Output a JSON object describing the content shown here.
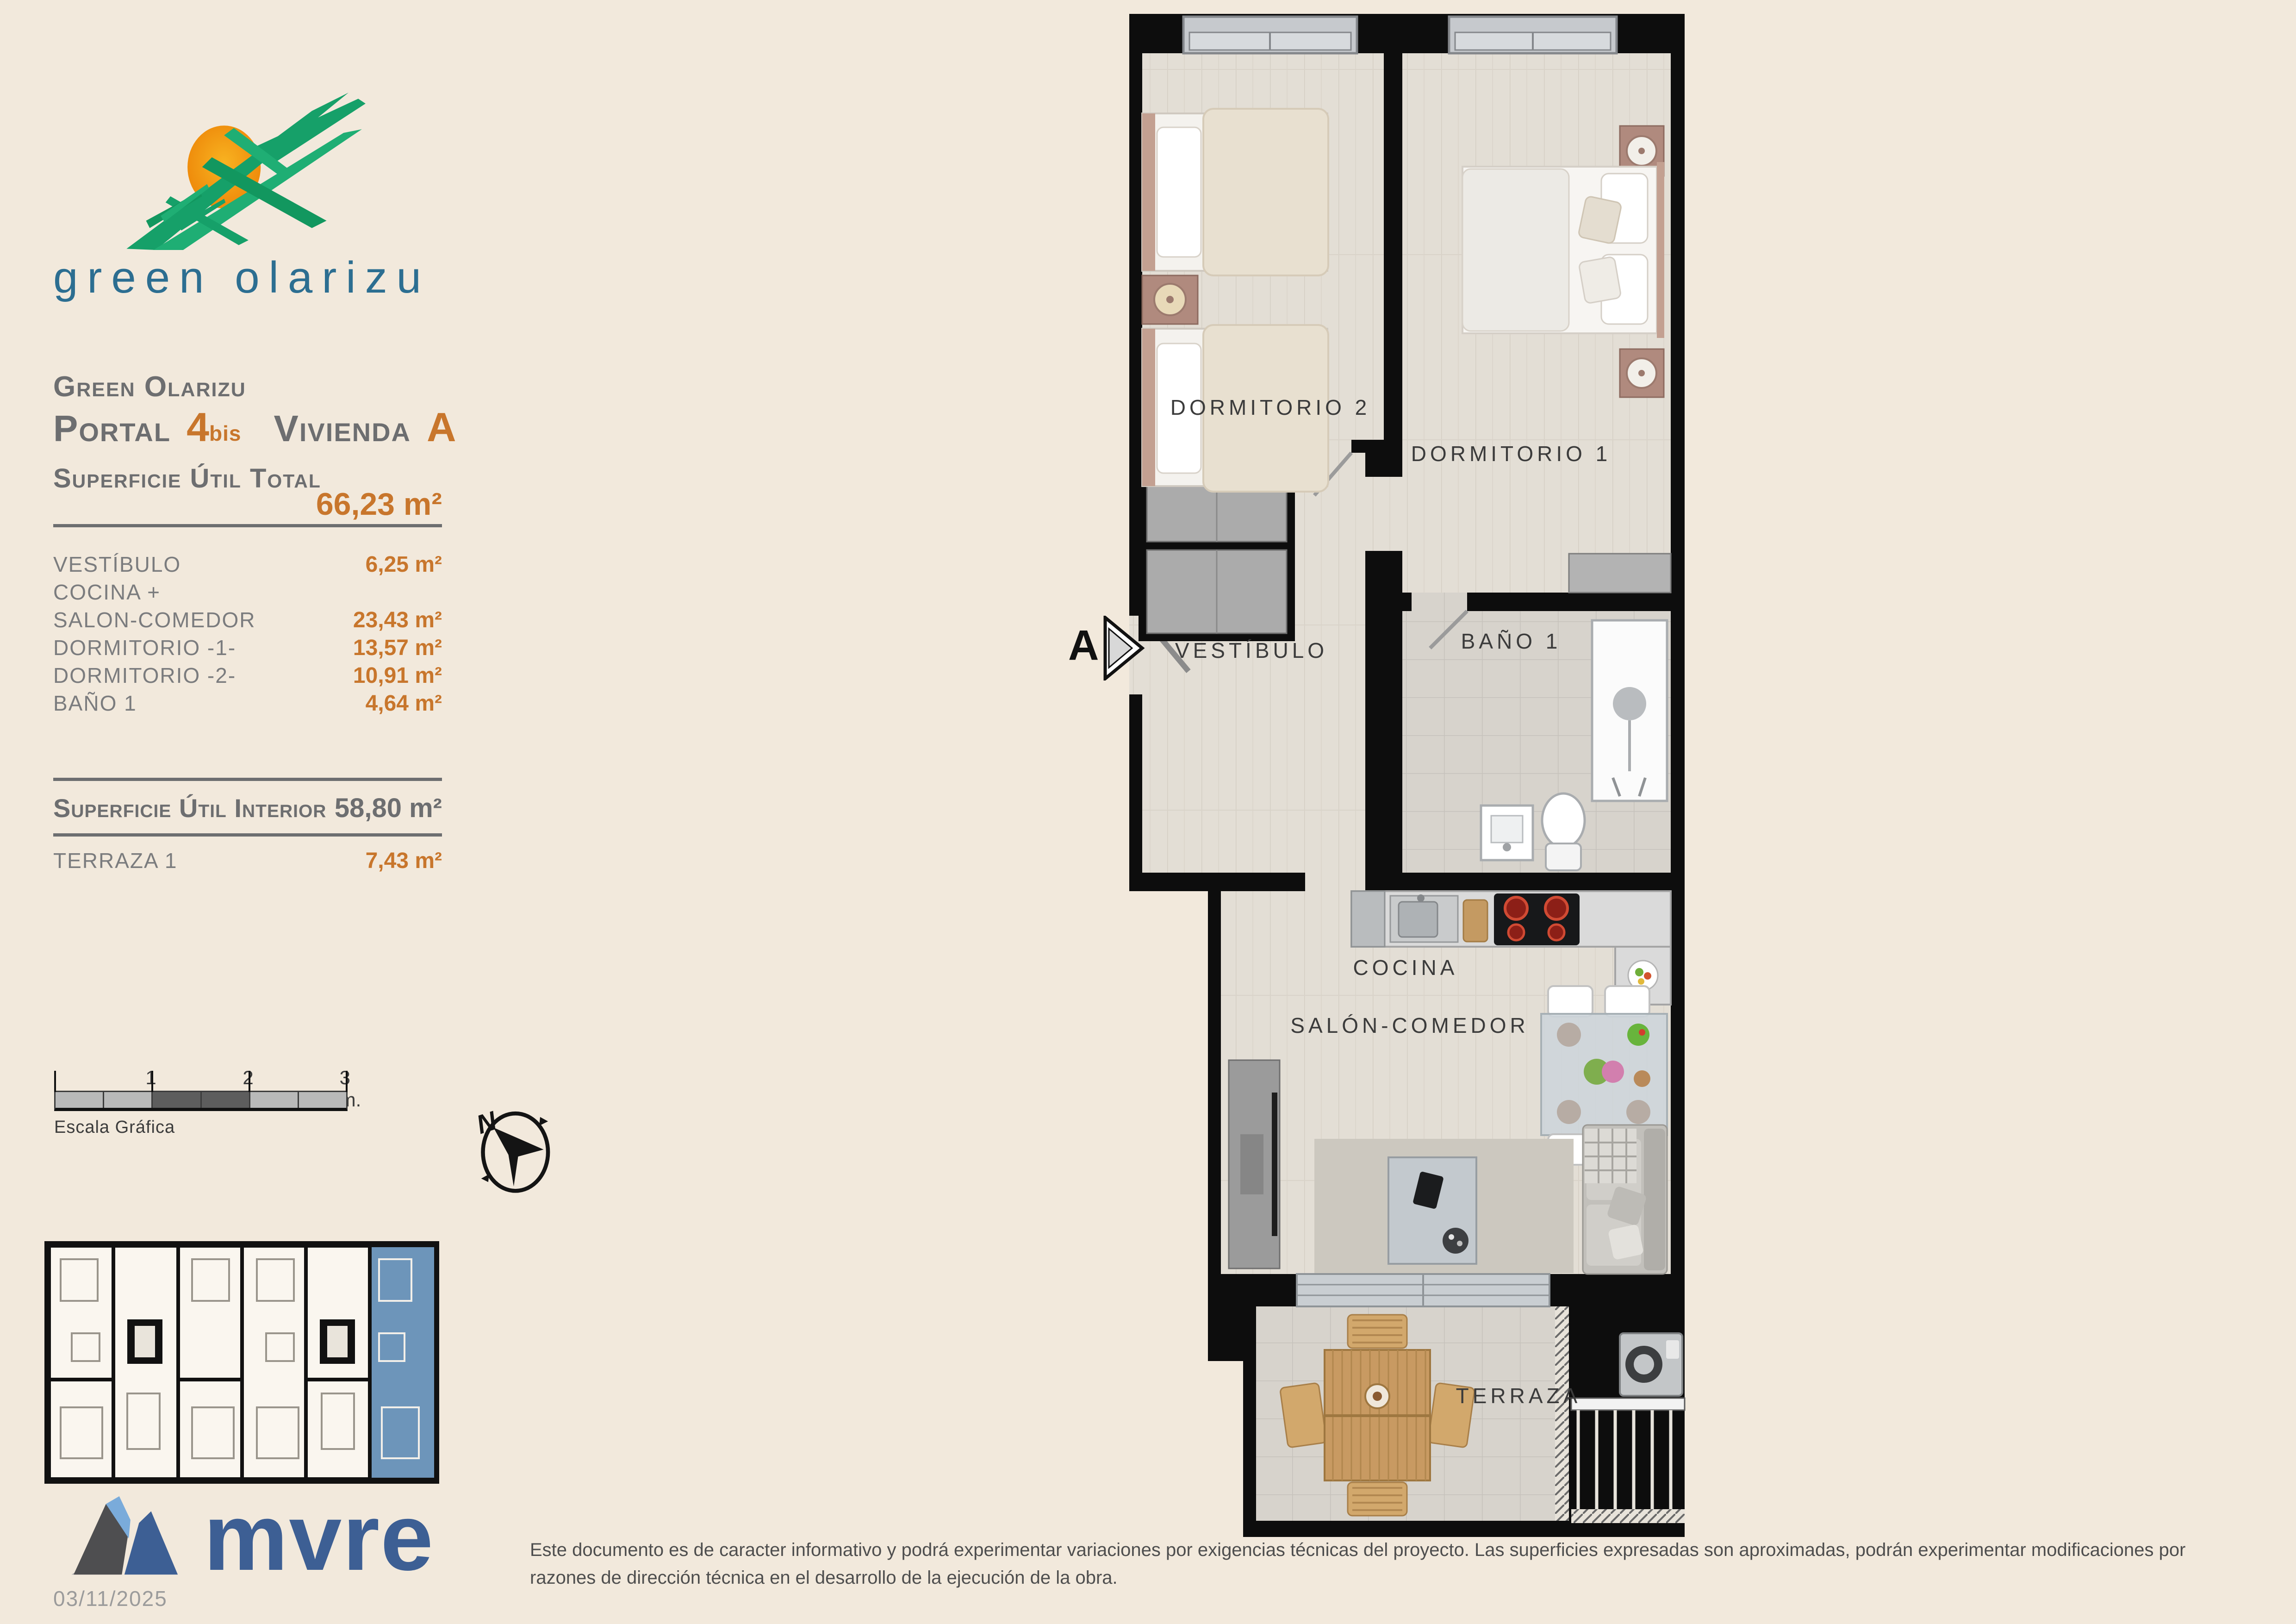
{
  "branding": {
    "logo_text": "green olarizu"
  },
  "header": {
    "project": "Green Olarizu",
    "portal_label": "Portal",
    "portal_number": "4",
    "portal_suffix": "bis",
    "unit_label": "Vivienda",
    "unit_letter": "A"
  },
  "areas": {
    "total_label": "Superficie Útil Total",
    "total_value": "66,23 m²",
    "rows": [
      {
        "label": "VESTÍBULO",
        "value": "6,25 m²"
      },
      {
        "label": "COCINA +",
        "value": ""
      },
      {
        "label": "SALON-COMEDOR",
        "value": "23,43 m²"
      },
      {
        "label": "DORMITORIO -1-",
        "value": "13,57 m²"
      },
      {
        "label": "DORMITORIO -2-",
        "value": "10,91 m²"
      },
      {
        "label": "BAÑO 1",
        "value": "4,64 m²"
      }
    ],
    "interior_label": "Superficie Útil Interior",
    "interior_value": "58,80 m²",
    "terrace_label": "TERRAZA 1",
    "terrace_value": "7,43 m²"
  },
  "scalebar": {
    "ticks": [
      "1",
      "2",
      "3 m."
    ],
    "caption": "Escala Gráfica"
  },
  "compass": {
    "north": "N"
  },
  "plan": {
    "section_marker": "A",
    "labels": {
      "dorm2": "DORMITORIO 2",
      "dorm1": "DORMITORIO 1",
      "vestibulo": "VESTÍBULO",
      "bano": "BAÑO 1",
      "cocina": "COCINA",
      "salon": "SALÓN-COMEDOR",
      "terraza": "TERRAZA"
    }
  },
  "footer": {
    "brand": "mvre",
    "date": "03/11/2025",
    "disclaimer": "Este documento es de caracter informativo y podrá experimentar variaciones por exigencias técnicas del proyecto. Las superficies expresadas son aproximadas, podrán experimentar modificaciones por razones de dirección técnica en el desarrollo de la ejecución de la obra."
  },
  "colors": {
    "background": "#f2e9dc",
    "accent_orange": "#c8762c",
    "text_gray": "#6d6e70",
    "logo_green": "#1aa168",
    "logo_sun_orange": "#f5a216",
    "logo_teal": "#2c6e91",
    "keyplan_highlight_blue": "#6d95ba",
    "mvre_blue": "#3d5f94",
    "wall_black": "#0d0d0d"
  }
}
